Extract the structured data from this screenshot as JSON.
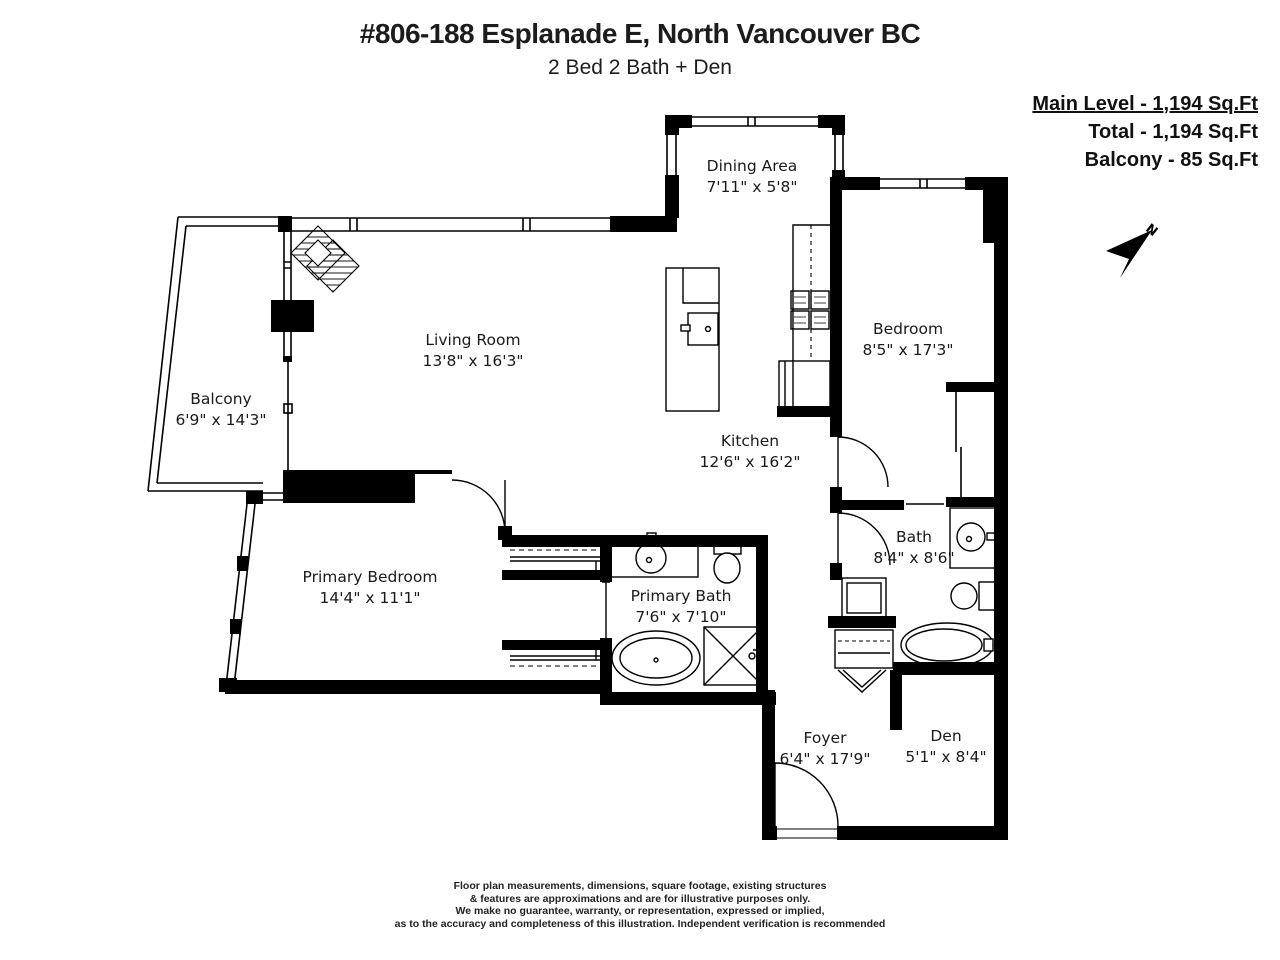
{
  "header": {
    "title": "#806-188 Esplanade E, North Vancouver BC",
    "subtitle": "2 Bed 2 Bath + Den"
  },
  "stats": {
    "main_level": "Main Level - 1,194 Sq.Ft",
    "total": "Total - 1,194 Sq.Ft",
    "balcony": "Balcony - 85 Sq.Ft"
  },
  "compass": {
    "label": "N"
  },
  "rooms": [
    {
      "name": "Dining Area",
      "dims": "7'11\" x 5'8\""
    },
    {
      "name": "Living Room",
      "dims": "13'8\" x 16'3\""
    },
    {
      "name": "Balcony",
      "dims": "6'9\" x 14'3\""
    },
    {
      "name": "Bedroom",
      "dims": "8'5\" x 17'3\""
    },
    {
      "name": "Kitchen",
      "dims": "12'6\" x 16'2\""
    },
    {
      "name": "Bath",
      "dims": "8'4\" x 8'6\""
    },
    {
      "name": "Primary Bedroom",
      "dims": "14'4\" x 11'1\""
    },
    {
      "name": "Primary Bath",
      "dims": "7'6\" x 7'10\""
    },
    {
      "name": "Foyer",
      "dims": "6'4\" x 17'9\""
    },
    {
      "name": "Den",
      "dims": "5'1\" x 8'4\""
    }
  ],
  "disclaimer_lines": [
    "Floor plan measurements, dimensions, square footage, existing structures",
    "& features are approximations and are for illustrative purposes only.",
    "We make no guarantee, warranty, or representation, expressed or implied,",
    "as to the accuracy and completeness of this illustration. Independent verification is recommended"
  ],
  "colors": {
    "wall": "#000000",
    "background": "#ffffff",
    "text": "#1a1a1a"
  }
}
